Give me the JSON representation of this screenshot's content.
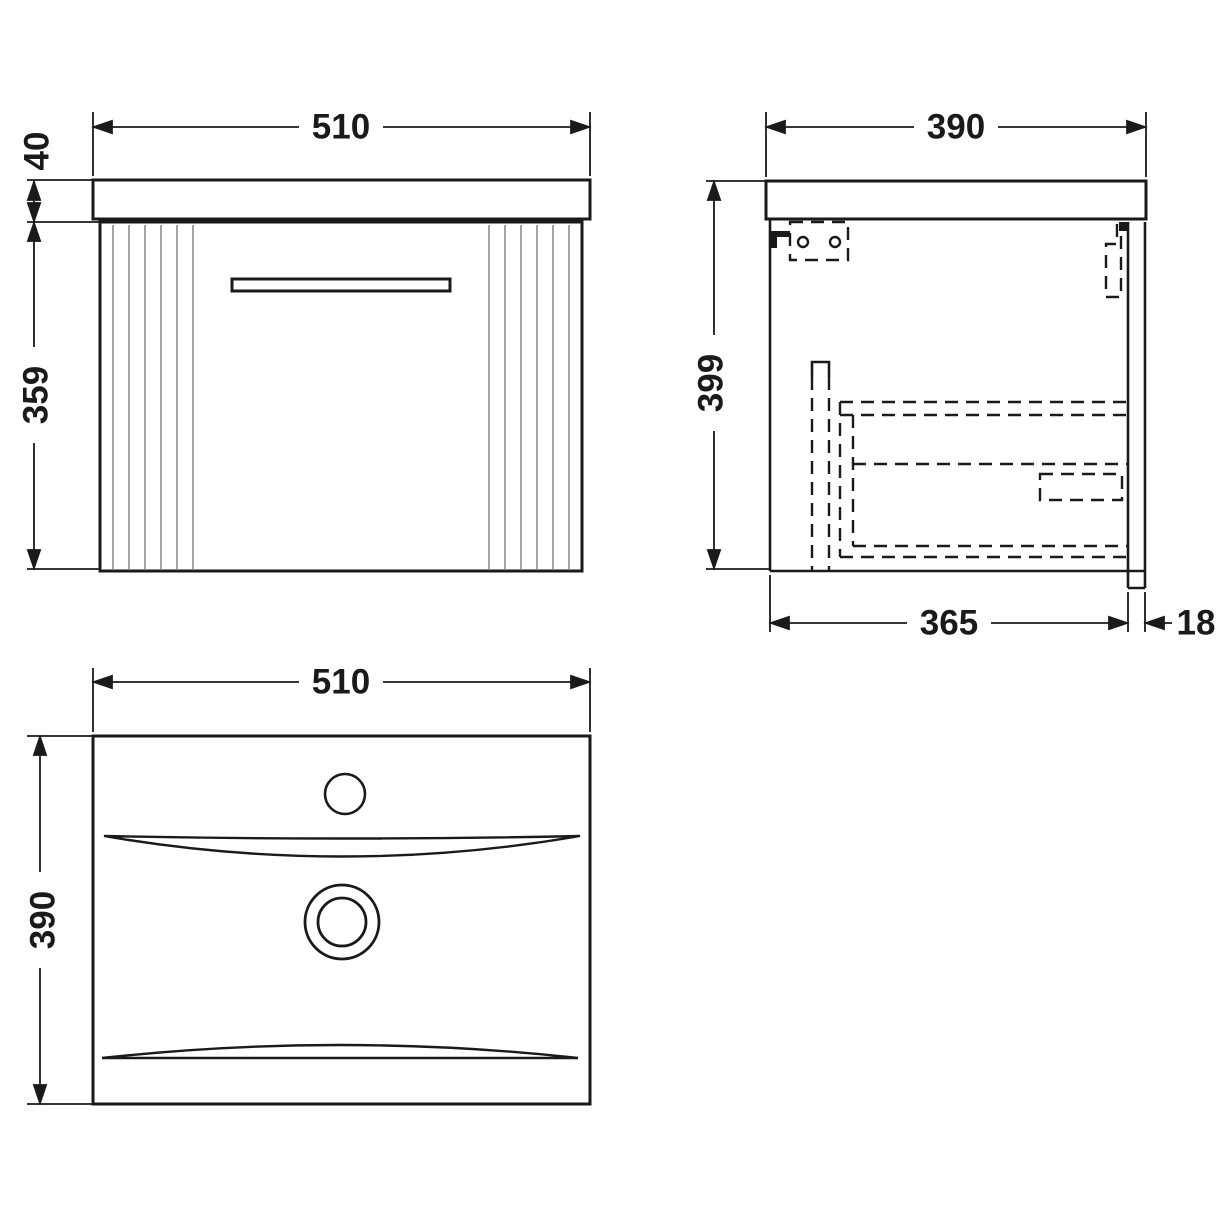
{
  "drawing": {
    "type": "technical-orthographic-drawing",
    "subject": "wall-hung vanity unit with basin",
    "units": "mm",
    "front_view": {
      "width_label": "510",
      "worktop_thickness_label": "40",
      "cabinet_height_label": "359"
    },
    "side_view": {
      "depth_label": "390",
      "overall_height_label": "399",
      "internal_depth_label": "365",
      "back_panel_thickness_label": "18"
    },
    "plan_view": {
      "width_label": "510",
      "depth_label": "390"
    },
    "colors": {
      "line": "#1a1a1a",
      "flute": "#9a9a9a",
      "background": "#ffffff"
    }
  }
}
